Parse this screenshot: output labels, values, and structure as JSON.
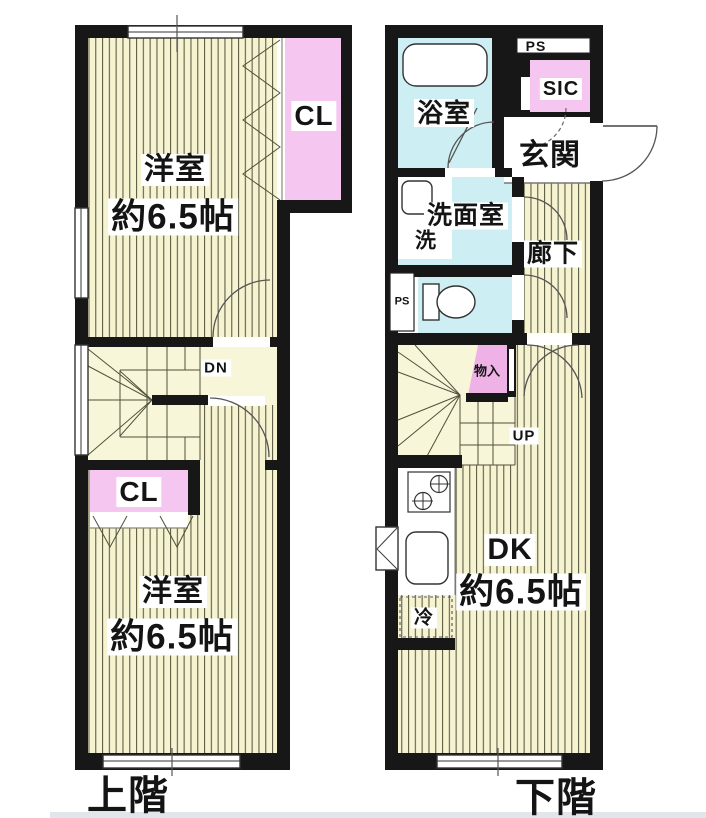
{
  "floorplan": {
    "upper": {
      "title": "上階",
      "room1_name": "洋室",
      "room1_size": "約6.5帖",
      "closet1": "CL",
      "stair_dir": "DN",
      "closet2": "CL",
      "room2_name": "洋室",
      "room2_size": "約6.5帖"
    },
    "lower": {
      "title": "下階",
      "bath": "浴室",
      "ps_top": "PS",
      "sic": "SIC",
      "entrance": "玄関",
      "washroom": "洗面室",
      "washer": "洗",
      "hallway": "廊下",
      "ps_side": "PS",
      "storage": "物入",
      "stair_dir": "UP",
      "dk_name": "DK",
      "dk_size": "約6.5帖",
      "fridge": "冷"
    }
  },
  "colors": {
    "wall": "#171717",
    "floor_base": "#f6f3d1",
    "stripe_line": "#5f5f49",
    "stair_floor": "#f8f6d9",
    "closet_pink": "#f5c6f0",
    "storage_pink": "#efb2e7",
    "wet_blue": "#cdeef3"
  }
}
